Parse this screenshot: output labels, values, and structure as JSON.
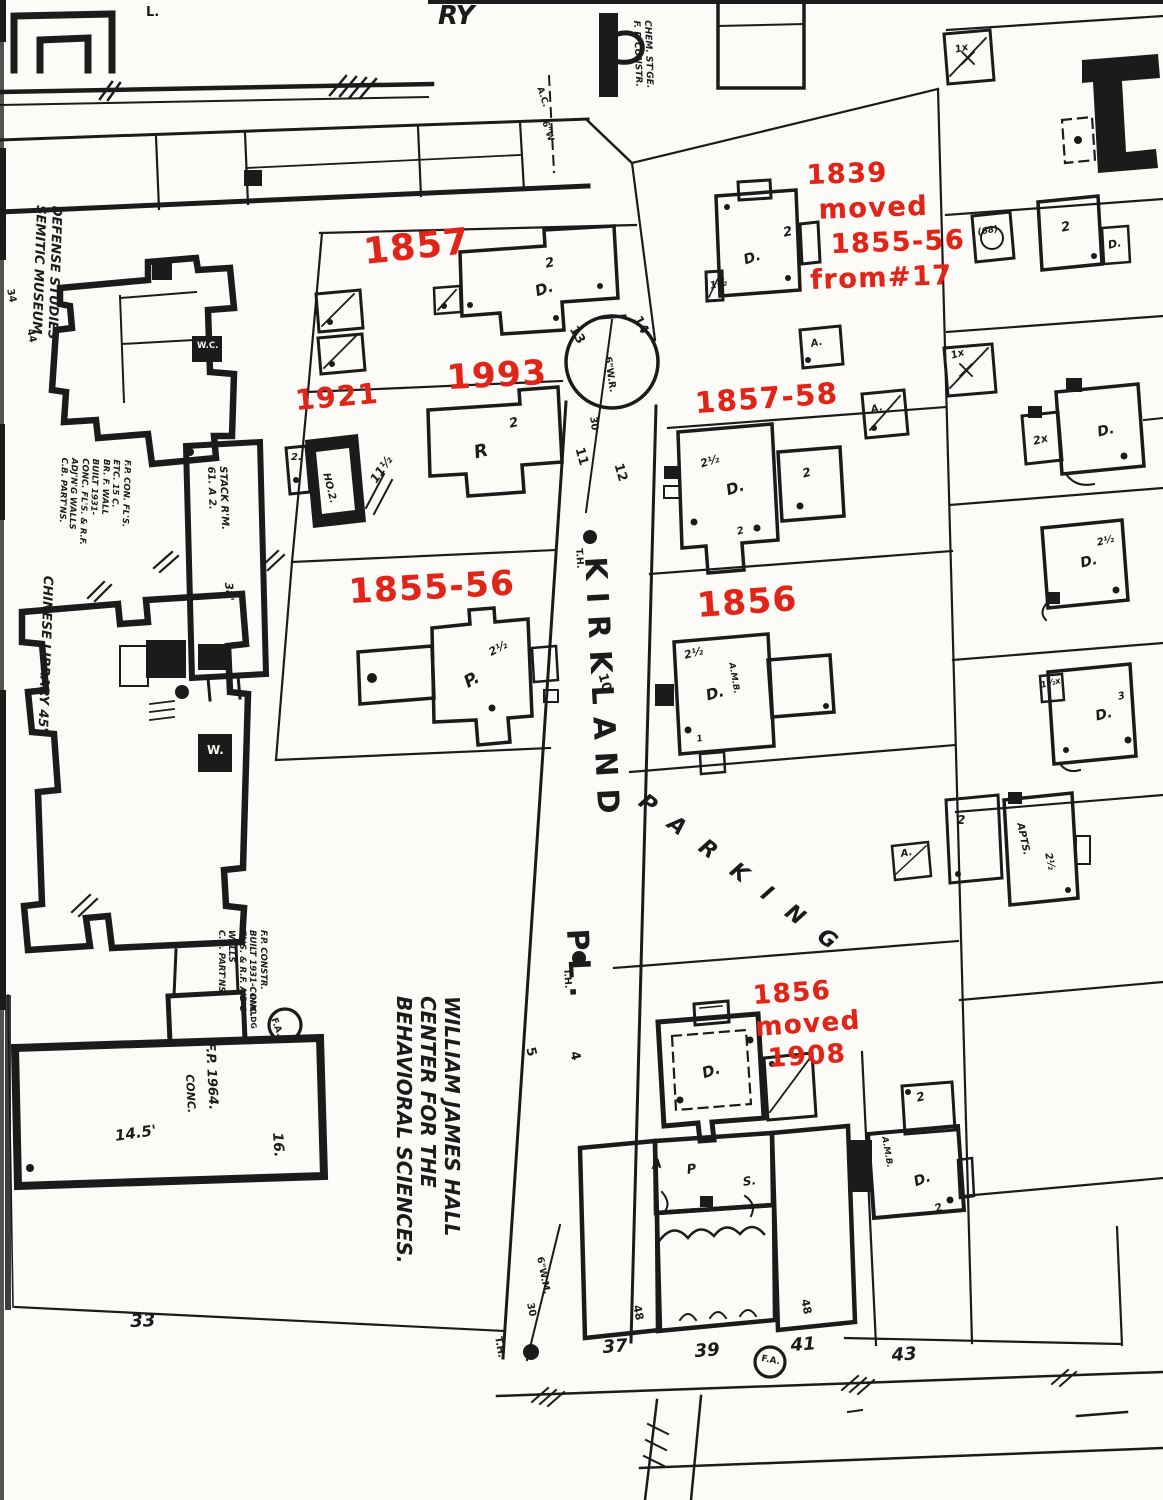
{
  "theme": {
    "paper": "#fcfbf7",
    "ink": "#1b1b1b",
    "red": "#e02418"
  },
  "map": {
    "red_annotations": [
      {
        "name": "annotation-1857",
        "text": "1857",
        "x": 362,
        "y": 234,
        "rot": -6,
        "size": 36
      },
      {
        "name": "annotation-1839-moved",
        "text": "1839\n moved\n  1855-56\nfrom#17",
        "x": 806,
        "y": 158,
        "rot": -2,
        "size": 27,
        "lh": 35
      },
      {
        "name": "annotation-1993",
        "text": "1993",
        "x": 446,
        "y": 360,
        "rot": -3,
        "size": 34
      },
      {
        "name": "annotation-1921",
        "text": "1921",
        "x": 294,
        "y": 386,
        "rot": -5,
        "size": 28
      },
      {
        "name": "annotation-1857-58",
        "text": "1857-58",
        "x": 694,
        "y": 388,
        "rot": -4,
        "size": 29
      },
      {
        "name": "annotation-1855-56",
        "text": "1855-56",
        "x": 348,
        "y": 574,
        "rot": -3,
        "size": 34
      },
      {
        "name": "annotation-1856",
        "text": "1856",
        "x": 696,
        "y": 588,
        "rot": -4,
        "size": 34
      },
      {
        "name": "annotation-1856-moved",
        "text": "1856\nmoved\n 1908",
        "x": 752,
        "y": 980,
        "rot": -4,
        "size": 26,
        "lh": 32
      }
    ],
    "labels": [
      {
        "name": "street-name-kirkland",
        "text": "KIRKLAND",
        "x": 610,
        "y": 556,
        "size": 30,
        "rot": 87,
        "ls": 12
      },
      {
        "name": "street-name-pl",
        "text": "PL.",
        "x": 592,
        "y": 928,
        "size": 30,
        "rot": 87,
        "ls": 8
      },
      {
        "name": "parking-label",
        "text": "PARKING",
        "x": 648,
        "y": 790,
        "size": 22,
        "rot": 37,
        "ls": 22,
        "i": 1
      },
      {
        "name": "lot-13",
        "text": "13",
        "x": 578,
        "y": 324,
        "rot": 60,
        "size": 13
      },
      {
        "name": "lot-14",
        "text": "14",
        "x": 642,
        "y": 314,
        "rot": 62,
        "size": 13
      },
      {
        "name": "lot-11",
        "text": "11",
        "x": 585,
        "y": 446,
        "rot": 74,
        "size": 13
      },
      {
        "name": "lot-12",
        "text": "12",
        "x": 624,
        "y": 462,
        "rot": 74,
        "size": 13
      },
      {
        "name": "lot-10",
        "text": "10",
        "x": 608,
        "y": 672,
        "rot": 74,
        "size": 13
      },
      {
        "name": "lot-5",
        "text": "5",
        "x": 536,
        "y": 1046,
        "rot": 76,
        "size": 13
      },
      {
        "name": "lot-4",
        "text": "4",
        "x": 580,
        "y": 1050,
        "rot": 76,
        "size": 13
      },
      {
        "name": "water-main-label",
        "text": "6\"W.R.",
        "x": 612,
        "y": 356,
        "rot": 82,
        "size": 9.5
      },
      {
        "name": "water-main-dim",
        "text": "30",
        "x": 597,
        "y": 416,
        "rot": 82,
        "size": 10
      },
      {
        "name": "water-main-label-2",
        "text": "6\"W.M.",
        "x": 544,
        "y": 1256,
        "rot": 79,
        "size": 9.5
      },
      {
        "name": "street-dim-30",
        "text": "30",
        "x": 534,
        "y": 1302,
        "rot": 79,
        "size": 10
      },
      {
        "name": "th-label-1",
        "text": "T.H.",
        "x": 583,
        "y": 548,
        "rot": 86,
        "size": 9.5
      },
      {
        "name": "th-label-2",
        "text": "T.H.",
        "x": 571,
        "y": 968,
        "rot": 86,
        "size": 9.5
      },
      {
        "name": "th-label-3",
        "text": "T.H.",
        "x": 502,
        "y": 1336,
        "rot": 80,
        "size": 10
      },
      {
        "name": "lot-33",
        "text": "33",
        "x": 130,
        "y": 1312,
        "rot": -2,
        "size": 18,
        "i": 1
      },
      {
        "name": "lot-37",
        "text": "37",
        "x": 602,
        "y": 1338,
        "rot": -4,
        "size": 18,
        "i": 1
      },
      {
        "name": "lot-39",
        "text": "39",
        "x": 694,
        "y": 1342,
        "rot": -4,
        "size": 18,
        "i": 1
      },
      {
        "name": "lot-41",
        "text": "41",
        "x": 790,
        "y": 1336,
        "rot": -4,
        "size": 18,
        "i": 1
      },
      {
        "name": "lot-43",
        "text": "43",
        "x": 891,
        "y": 1346,
        "rot": -4,
        "size": 18,
        "i": 1
      },
      {
        "name": "dim-48-left",
        "text": "48",
        "x": 642,
        "y": 1304,
        "rot": 78,
        "size": 11
      },
      {
        "name": "dim-48-right",
        "text": "48",
        "x": 810,
        "y": 1298,
        "rot": 78,
        "size": 11
      },
      {
        "name": "william-james-hall-label",
        "text": "WILLIAM JAMES HALL\nCENTER FOR THE\nBEHAVIORAL SCIENCES.",
        "x": 464,
        "y": 996,
        "rot": 90,
        "size": 20,
        "lh": 24,
        "i": 1
      },
      {
        "name": "semitic-museum-label",
        "text": "DEFENSE STUDIES\nSEMITIC MUSEUM",
        "x": 64,
        "y": 206,
        "rot": 92,
        "size": 13,
        "lh": 16,
        "i": 1
      },
      {
        "name": "chinese-library-label",
        "text": "CHINESE LIBRARY 45'",
        "x": 54,
        "y": 576,
        "rot": 92,
        "size": 13,
        "i": 1
      },
      {
        "name": "stack-room-label",
        "text": "STACK R'M.\n61. A 2.",
        "x": 228,
        "y": 466,
        "rot": 88,
        "size": 10,
        "lh": 12,
        "i": 1
      },
      {
        "name": "stack-dim",
        "text": "38'",
        "x": 234,
        "y": 582,
        "rot": 86,
        "size": 11,
        "i": 1
      },
      {
        "name": "wjh-fp-label",
        "text": "F.P. 1964.",
        "x": 216,
        "y": 1042,
        "rot": 87,
        "size": 13,
        "i": 1
      },
      {
        "name": "wjh-conc-label",
        "text": "CONC.",
        "x": 195,
        "y": 1074,
        "rot": 87,
        "size": 11,
        "i": 1
      },
      {
        "name": "wjh-dim",
        "text": "14.5'",
        "x": 114,
        "y": 1128,
        "rot": -8,
        "size": 15,
        "i": 1
      },
      {
        "name": "wjh-number-16",
        "text": "16.",
        "x": 284,
        "y": 1132,
        "rot": 86,
        "size": 14,
        "i": 1
      },
      {
        "name": "fa-top-label",
        "text": "F.A.",
        "x": 277,
        "y": 1017,
        "rot": 70,
        "size": 9
      },
      {
        "name": "fa-inbldg-label",
        "text": "IN BLDG",
        "x": 256,
        "y": 994,
        "rot": 88,
        "size": 7.5
      },
      {
        "name": "fa-bottom-label",
        "text": "F.A.",
        "x": 762,
        "y": 1355,
        "rot": 10,
        "size": 9
      },
      {
        "name": "museum-notes",
        "text": "F.P. CON. FL'S.\nETC. 15 C.\nBR. F. WALL\nBUILT 1931-\nCONC. FL'S. & R.F.\nADJ'N'G WALLS\nC.B. PART'NS.",
        "x": 132,
        "y": 460,
        "rot": 92,
        "size": 8.5,
        "lh": 10.5,
        "i": 1
      },
      {
        "name": "wjh-notes",
        "text": "F.P. CONSTR.\nBUILT 1931-CONC.\nFL'S. & R.F. A'B'G\nWALLS\nC.O. PART'NS.",
        "x": 268,
        "y": 930,
        "rot": 90,
        "size": 8.5,
        "lh": 10.5,
        "i": 1
      },
      {
        "name": "chem-storage-label",
        "text": "CHEM. ST'GE.\nF. P. CONSTR.",
        "x": 652,
        "y": 20,
        "rot": 88,
        "size": 9,
        "lh": 11,
        "i": 1
      },
      {
        "name": "pipe-ac-label",
        "text": "A.C.",
        "x": 543,
        "y": 86,
        "rot": 72,
        "size": 9
      },
      {
        "name": "pipe-6w-label",
        "text": "6\"W",
        "x": 548,
        "y": 120,
        "rot": 72,
        "size": 9
      },
      {
        "name": "corner-ry",
        "text": "RY",
        "x": 438,
        "y": 2,
        "size": 26,
        "i": 1
      },
      {
        "name": "corner-l",
        "text": "L.",
        "x": 146,
        "y": 6,
        "size": 13
      },
      {
        "name": "corner-5a",
        "text": "5a.",
        "x": 2,
        "y": 226,
        "rot": 78,
        "size": 11
      },
      {
        "name": "museum-34",
        "text": "34",
        "x": 14,
        "y": 288,
        "rot": 78,
        "size": 10
      },
      {
        "name": "museum-44",
        "text": "44",
        "x": 34,
        "y": 328,
        "rot": 78,
        "size": 10
      },
      {
        "name": "house-1839-storeys-porch",
        "text": "1½",
        "x": 709,
        "y": 282,
        "rot": -12,
        "size": 10,
        "i": 1
      },
      {
        "name": "house-1839-storeys",
        "text": "2",
        "x": 782,
        "y": 227,
        "rot": -12,
        "size": 13,
        "i": 1
      },
      {
        "name": "house-1839-type",
        "text": "D.",
        "x": 742,
        "y": 254,
        "rot": -18,
        "size": 14,
        "i": 1
      },
      {
        "name": "privy-a-label",
        "text": "A.",
        "x": 810,
        "y": 340,
        "rot": -12,
        "size": 10,
        "i": 1
      },
      {
        "name": "privy-b-label",
        "text": "A.",
        "x": 870,
        "y": 406,
        "rot": -15,
        "size": 10,
        "i": 1
      },
      {
        "name": "house-1857-storeys",
        "text": "2",
        "x": 544,
        "y": 258,
        "rot": -12,
        "size": 13,
        "i": 1
      },
      {
        "name": "house-1857-type",
        "text": "D.",
        "x": 533,
        "y": 284,
        "rot": -18,
        "size": 15,
        "i": 1
      },
      {
        "name": "house-1993-storeys",
        "text": "2",
        "x": 508,
        "y": 418,
        "rot": -12,
        "size": 13,
        "i": 1
      },
      {
        "name": "house-1993-type",
        "text": "R",
        "x": 472,
        "y": 444,
        "rot": -14,
        "size": 18,
        "i": 1
      },
      {
        "name": "house-1921-label",
        "text": "HO.2.",
        "x": 330,
        "y": 472,
        "rot": 76,
        "size": 10,
        "i": 1
      },
      {
        "name": "house-1921-annex",
        "text": "2.",
        "x": 291,
        "y": 453,
        "size": 10,
        "i": 1
      },
      {
        "name": "dim-11half",
        "text": "11½",
        "x": 368,
        "y": 478,
        "rot": -55,
        "size": 12,
        "i": 1
      },
      {
        "name": "house-1855-storeys",
        "text": "2½",
        "x": 487,
        "y": 648,
        "rot": -28,
        "size": 11,
        "i": 1
      },
      {
        "name": "house-1855-type",
        "text": "P.",
        "x": 461,
        "y": 676,
        "rot": -30,
        "size": 17,
        "i": 1
      },
      {
        "name": "house-185758-storeys",
        "text": "2½",
        "x": 699,
        "y": 459,
        "rot": -18,
        "size": 11,
        "i": 1
      },
      {
        "name": "house-185758-type",
        "text": "D.",
        "x": 724,
        "y": 483,
        "rot": -18,
        "size": 15,
        "i": 1
      },
      {
        "name": "house-185758-wing",
        "text": "2",
        "x": 801,
        "y": 468,
        "rot": -15,
        "size": 12,
        "i": 1
      },
      {
        "name": "house-185758-rear",
        "text": "2",
        "x": 736,
        "y": 528,
        "rot": -15,
        "size": 10,
        "i": 1
      },
      {
        "name": "house-1856-storeys",
        "text": "2½",
        "x": 683,
        "y": 650,
        "rot": -14,
        "size": 11,
        "i": 1
      },
      {
        "name": "house-1856-amb",
        "text": "A.M.B.",
        "x": 735,
        "y": 662,
        "rot": 80,
        "size": 8.5,
        "i": 1
      },
      {
        "name": "house-1856-type",
        "text": "D.",
        "x": 704,
        "y": 688,
        "rot": -16,
        "size": 15,
        "i": 1
      },
      {
        "name": "house-1856-rear",
        "text": "1",
        "x": 696,
        "y": 736,
        "rot": -10,
        "size": 9,
        "i": 1
      },
      {
        "name": "house-1856moved-type",
        "text": "D.",
        "x": 700,
        "y": 1066,
        "rot": -18,
        "size": 15,
        "i": 1
      },
      {
        "name": "rowhouse-a",
        "text": "A",
        "x": 651,
        "y": 1159,
        "rot": -8,
        "size": 13,
        "i": 1
      },
      {
        "name": "rowhouse-p",
        "text": "P",
        "x": 686,
        "y": 1164,
        "rot": -8,
        "size": 13,
        "i": 1
      },
      {
        "name": "rowhouse-s",
        "text": "S.",
        "x": 742,
        "y": 1176,
        "rot": -8,
        "size": 12,
        "i": 1
      },
      {
        "name": "amb-house-storeys-top",
        "text": "2",
        "x": 915,
        "y": 1092,
        "rot": -14,
        "size": 12,
        "i": 1
      },
      {
        "name": "amb-house-amb",
        "text": "A.M.B.",
        "x": 888,
        "y": 1136,
        "rot": 80,
        "size": 8.5,
        "i": 1
      },
      {
        "name": "amb-house-type",
        "text": "D.",
        "x": 912,
        "y": 1176,
        "rot": -20,
        "size": 14,
        "i": 1
      },
      {
        "name": "amb-house-storeys",
        "text": "2",
        "x": 933,
        "y": 1204,
        "rot": -20,
        "size": 11,
        "i": 1
      },
      {
        "name": "rc-1x-top",
        "text": "1x",
        "x": 954,
        "y": 46,
        "rot": -14,
        "size": 10,
        "i": 1
      },
      {
        "name": "rc-68",
        "text": "(68)",
        "x": 977,
        "y": 229,
        "rot": -10,
        "size": 9,
        "i": 1
      },
      {
        "name": "rc-2-top",
        "text": "2",
        "x": 1060,
        "y": 222,
        "rot": -12,
        "size": 13,
        "i": 1
      },
      {
        "name": "rc-d-top",
        "text": "D.",
        "x": 1107,
        "y": 240,
        "rot": -12,
        "size": 11,
        "i": 1
      },
      {
        "name": "rc-1x-mid",
        "text": "1x",
        "x": 950,
        "y": 352,
        "rot": -16,
        "size": 10,
        "i": 1
      },
      {
        "name": "rc-2x",
        "text": "2x",
        "x": 1032,
        "y": 436,
        "rot": -14,
        "size": 11,
        "i": 1
      },
      {
        "name": "rc-d-1",
        "text": "D.",
        "x": 1096,
        "y": 426,
        "rot": -14,
        "size": 14,
        "i": 1
      },
      {
        "name": "rc-2half",
        "text": "2½",
        "x": 1096,
        "y": 539,
        "rot": -14,
        "size": 10,
        "i": 1
      },
      {
        "name": "rc-d-2",
        "text": "D.",
        "x": 1079,
        "y": 557,
        "rot": -14,
        "size": 14,
        "i": 1
      },
      {
        "name": "rc-1halfx",
        "text": "1½x",
        "x": 1040,
        "y": 682,
        "rot": -14,
        "size": 8.5,
        "i": 1
      },
      {
        "name": "rc-d-3",
        "text": "D.",
        "x": 1094,
        "y": 710,
        "rot": -14,
        "size": 14,
        "i": 1
      },
      {
        "name": "rc-3",
        "text": "3",
        "x": 1117,
        "y": 693,
        "rot": -14,
        "size": 10,
        "i": 1
      },
      {
        "name": "rc-2-apts",
        "text": "2",
        "x": 957,
        "y": 814,
        "size": 12,
        "i": 1
      },
      {
        "name": "rc-a-small",
        "text": "A.",
        "x": 900,
        "y": 850,
        "rot": -10,
        "size": 10,
        "i": 1
      },
      {
        "name": "rc-apts",
        "text": "APTS.",
        "x": 1024,
        "y": 822,
        "rot": 78,
        "size": 10,
        "i": 1
      },
      {
        "name": "rc-apts-storeys",
        "text": "2½",
        "x": 1052,
        "y": 852,
        "rot": 78,
        "size": 10,
        "i": 1
      }
    ],
    "white_labels": [
      {
        "name": "wc-label",
        "text": "W.C.",
        "x": 197,
        "y": 342,
        "size": 8.5
      },
      {
        "name": "w-label",
        "text": "W.",
        "x": 207,
        "y": 744,
        "size": 12
      }
    ]
  }
}
